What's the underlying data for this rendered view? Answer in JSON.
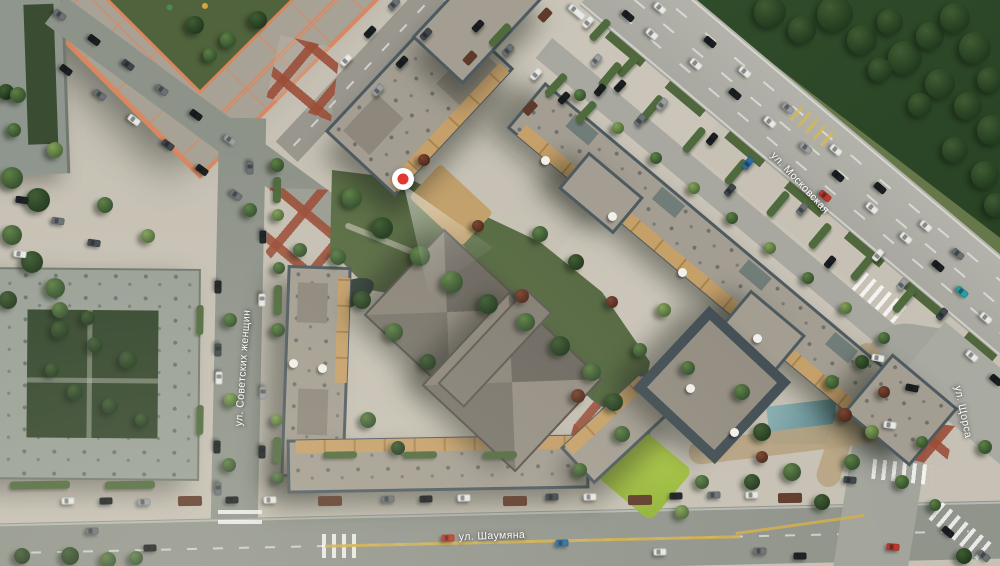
{
  "map": {
    "streets": [
      {
        "id": "sovetskikh-zhenshchin",
        "label": "ул. Советских женщин"
      },
      {
        "id": "moskovskaya",
        "label": "ул. Московская"
      },
      {
        "id": "shaumyana",
        "label": "ул. Шаумяна"
      },
      {
        "id": "schorsa",
        "label": "ул. Щорса"
      }
    ],
    "marker": {
      "name": "viewpoint-marker",
      "x": 403,
      "y": 179,
      "dot_color": "#e0382e",
      "ring_color": "#ffffff"
    },
    "colors": {
      "pavement": "#c6c1b4",
      "road": "#a9aaa2",
      "roof_gray": "#a49e92",
      "building_trim_orange": "#d8875f",
      "parapet": "#4d5a60",
      "terrace_wood": "#c7a069",
      "forest": "#2f4c2b",
      "lawn_bright": "#a9c73e",
      "pond": "#5f8f97",
      "plaza_red": "#9e533e"
    }
  }
}
